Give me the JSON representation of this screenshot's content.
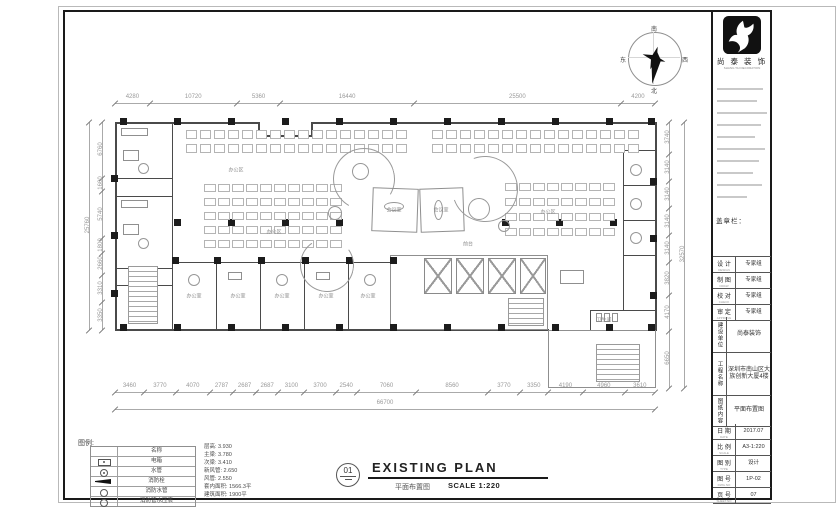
{
  "sheet": {
    "drawing_title": {
      "number": "01",
      "title": "EXISTING PLAN",
      "title_cn": "平面布置图",
      "scale": "SCALE 1:220"
    }
  },
  "compass": {
    "south": "南",
    "north": "北",
    "east": "东",
    "west": "西"
  },
  "dimensions": {
    "top": {
      "segments": [
        "4280",
        "10720",
        "5360",
        "16440",
        "25500",
        "4200"
      ]
    },
    "bottom": {
      "segments": [
        "3460",
        "3770",
        "4070",
        "2787",
        "2687",
        "2687",
        "3100",
        "3700",
        "2540",
        "7060",
        "8560",
        "3770",
        "3350",
        "4190",
        "4960",
        "3610"
      ],
      "total": "66700"
    },
    "left": {
      "segments": [
        "6760",
        "1600",
        "5740",
        "1800",
        "2660",
        "3310",
        "3350"
      ],
      "total": "25760"
    },
    "right": {
      "segments": [
        "3740",
        "3140",
        "3140",
        "3140",
        "3140",
        "3820",
        "4170",
        "6650"
      ],
      "total": "32570"
    }
  },
  "legend": {
    "title": "图例:",
    "rows": [
      {
        "symbol": "none",
        "name": "名称"
      },
      {
        "symbol": "ebox",
        "name": "电箱"
      },
      {
        "symbol": "pipe",
        "name": "水管"
      },
      {
        "symbol": "hydrant",
        "name": "消防栓"
      },
      {
        "symbol": "circle",
        "name": "消防水管"
      },
      {
        "symbol": "circle",
        "name": "消防管水压表"
      }
    ],
    "notes": [
      "层高: 3.930",
      "主梁: 3.780",
      "次梁: 3.410",
      "新风管: 2.650",
      "风管: 2.550",
      "套内面积: 1566.3平",
      "建筑面积: 1900平"
    ]
  },
  "title_block": {
    "company": "尚 泰 装 饰",
    "company_caption": "SHANG TAI DECORATION",
    "stamp_label": "盖章栏：",
    "rows": [
      {
        "label": "设 计",
        "sub": "DESIGN",
        "value": "专家组"
      },
      {
        "label": "制 图",
        "sub": "DRAW",
        "value": "专家组"
      },
      {
        "label": "校 对",
        "sub": "CHECK",
        "value": "专家组"
      },
      {
        "label": "审 定",
        "sub": "APPROVE",
        "value": "专家组"
      }
    ],
    "vrows": [
      {
        "label": "建设单位",
        "value": "尚泰装饰"
      },
      {
        "label": "工程名称",
        "value": "深圳市南山区大族创新大厦4楼"
      },
      {
        "label": "图纸内容",
        "value": "平面布置图"
      }
    ],
    "brows": [
      {
        "label": "日 期",
        "sub": "DATE",
        "value": "2017.07"
      },
      {
        "label": "比 例",
        "sub": "SCALE",
        "value": "A3-1:220"
      },
      {
        "label": "图 别",
        "sub": "TYPE",
        "value": "设计"
      },
      {
        "label": "图 号",
        "sub": "DWG.NO",
        "value": "1P-02"
      },
      {
        "label": "页 号",
        "sub": "SHEET.NO",
        "value": "07"
      }
    ]
  },
  "plan_labels": [
    {
      "text": "办公区",
      "x": 236,
      "y": 170
    },
    {
      "text": "办公区",
      "x": 274,
      "y": 232
    },
    {
      "text": "办公区",
      "x": 548,
      "y": 212
    },
    {
      "text": "会议室",
      "x": 394,
      "y": 210
    },
    {
      "text": "会议室",
      "x": 441,
      "y": 210
    },
    {
      "text": "前台",
      "x": 468,
      "y": 244
    },
    {
      "text": "办公室",
      "x": 194,
      "y": 296
    },
    {
      "text": "办公室",
      "x": 238,
      "y": 296
    },
    {
      "text": "办公室",
      "x": 282,
      "y": 296
    },
    {
      "text": "办公室",
      "x": 326,
      "y": 296
    },
    {
      "text": "办公室",
      "x": 368,
      "y": 296
    },
    {
      "text": "卫生间",
      "x": 604,
      "y": 320
    }
  ]
}
